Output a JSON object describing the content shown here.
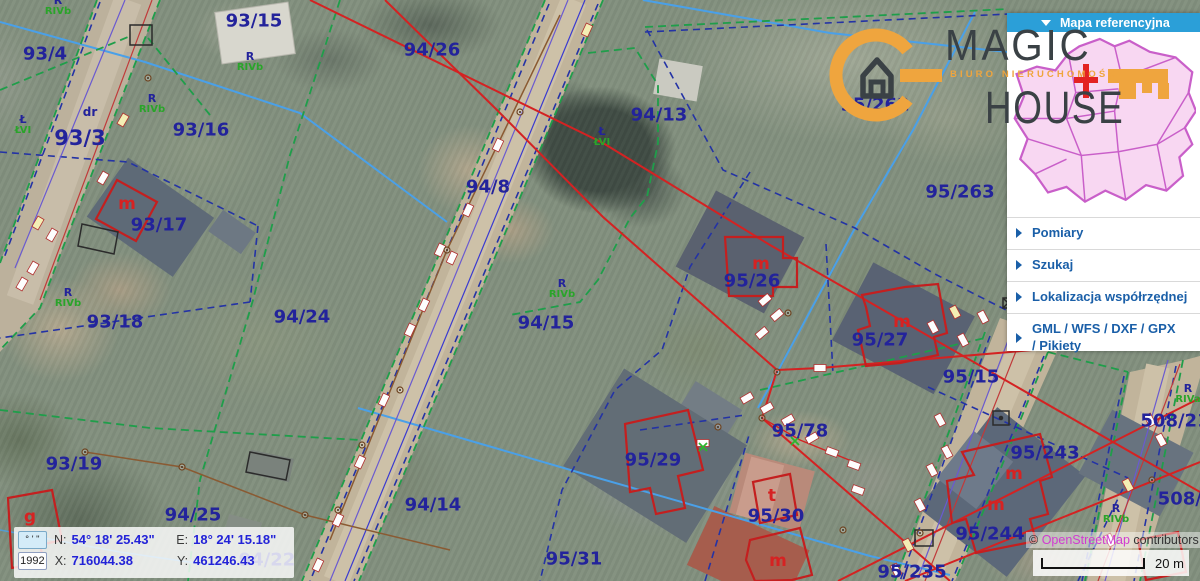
{
  "colors": {
    "header_blue": "#2b9fd8",
    "menu_blue": "#1a5fa8",
    "parcel_navy": "#23239b",
    "soil_green": "#2aa42a",
    "cadastral_red": "#d42222",
    "logo_orange": "#efa53e",
    "osm_link_pink": "#d13bd1"
  },
  "sidebar": {
    "header": "Mapa referencyjna",
    "items": [
      {
        "label": "Pomiary"
      },
      {
        "label": "Szukaj"
      },
      {
        "label": "Lokalizacja współrzędnej"
      },
      {
        "label": "GML / WFS / DXF / GPX / Pikiety"
      }
    ]
  },
  "logo": {
    "line1": "MAGIC",
    "line2": "HOUSE",
    "tagline": "BIURO NIERUCHOMOŚCI"
  },
  "coords_panel": {
    "dms_button": "° ' \"",
    "year_button": "1992",
    "n_label": "N:",
    "n_value": "54° 18' 25.43\"",
    "e_label": "E:",
    "e_value": "18° 24' 15.18\"",
    "x_label": "X:",
    "x_value": "716044.38",
    "y_label": "Y:",
    "y_value": "461246.43"
  },
  "attribution": {
    "prefix": "© ",
    "link": "OpenStreetMap",
    "suffix": " contributors"
  },
  "scale": {
    "label": "20 m"
  },
  "map": {
    "parcel_labels": [
      {
        "t": "93/15",
        "x": 254,
        "y": 21
      },
      {
        "t": "93/4",
        "x": 45,
        "y": 54
      },
      {
        "t": "94/26",
        "x": 432,
        "y": 50
      },
      {
        "t": "94/13",
        "x": 659,
        "y": 115
      },
      {
        "t": "95/262",
        "x": 875,
        "y": 105
      },
      {
        "t": "93/16",
        "x": 201,
        "y": 130
      },
      {
        "t": "93/3",
        "x": 80,
        "y": 138,
        "fs": 21
      },
      {
        "t": "93/17",
        "x": 159,
        "y": 225
      },
      {
        "t": "94/8",
        "x": 488,
        "y": 187
      },
      {
        "t": "95/263",
        "x": 960,
        "y": 192
      },
      {
        "t": "93/18",
        "x": 115,
        "y": 322
      },
      {
        "t": "94/24",
        "x": 302,
        "y": 317
      },
      {
        "t": "94/15",
        "x": 546,
        "y": 323
      },
      {
        "t": "95/26",
        "x": 752,
        "y": 281
      },
      {
        "t": "95/27",
        "x": 880,
        "y": 340
      },
      {
        "t": "95/15",
        "x": 971,
        "y": 377
      },
      {
        "t": "93/19",
        "x": 74,
        "y": 464
      },
      {
        "t": "94/25",
        "x": 193,
        "y": 515
      },
      {
        "t": "94/14",
        "x": 433,
        "y": 505
      },
      {
        "t": "95/29",
        "x": 653,
        "y": 460
      },
      {
        "t": "95/78",
        "x": 800,
        "y": 431
      },
      {
        "t": "95/30",
        "x": 776,
        "y": 516
      },
      {
        "t": "95/31",
        "x": 574,
        "y": 559
      },
      {
        "t": "94/22",
        "x": 267,
        "y": 560
      },
      {
        "t": "95/235",
        "x": 912,
        "y": 572
      },
      {
        "t": "95/243",
        "x": 1045,
        "y": 453
      },
      {
        "t": "95/244",
        "x": 990,
        "y": 534
      },
      {
        "t": "508/21",
        "x": 1175,
        "y": 421
      },
      {
        "t": "508/3",
        "x": 1186,
        "y": 499
      }
    ],
    "red_labels": [
      {
        "t": "m",
        "x": 127,
        "y": 204
      },
      {
        "t": "m",
        "x": 761,
        "y": 264
      },
      {
        "t": "m",
        "x": 902,
        "y": 322
      },
      {
        "t": "m",
        "x": 1014,
        "y": 474
      },
      {
        "t": "m",
        "x": 996,
        "y": 505
      },
      {
        "t": "m",
        "x": 778,
        "y": 561
      },
      {
        "t": "t",
        "x": 772,
        "y": 496
      },
      {
        "t": "g",
        "x": 30,
        "y": 517
      }
    ],
    "soil_labels": [
      {
        "a": "R",
        "b": "RIVb",
        "x": 58,
        "y": 6
      },
      {
        "a": "R",
        "b": "RIVb",
        "x": 250,
        "y": 62
      },
      {
        "a": "R",
        "b": "RIVb",
        "x": 152,
        "y": 104
      },
      {
        "a": "Ł",
        "b": "ŁVI",
        "x": 23,
        "y": 125
      },
      {
        "a": "R",
        "b": "RIVb",
        "x": 68,
        "y": 298
      },
      {
        "a": "R",
        "b": "RIVb",
        "x": 562,
        "y": 289
      },
      {
        "a": "Ł",
        "b": "ŁVI",
        "x": 602,
        "y": 137
      },
      {
        "a": "R",
        "b": "RIVa",
        "x": 1188,
        "y": 394
      },
      {
        "a": "R",
        "b": "RIVb",
        "x": 1116,
        "y": 514
      }
    ],
    "road_label": {
      "t": "dr",
      "x": 90,
      "y": 112
    },
    "utility_boxes": [
      {
        "x": 587,
        "y": 30,
        "r": -65,
        "c": "y"
      },
      {
        "x": 498,
        "y": 145,
        "r": -65,
        "c": "w"
      },
      {
        "x": 468,
        "y": 210,
        "r": -65,
        "c": "w"
      },
      {
        "x": 440,
        "y": 250,
        "r": -65,
        "c": "w"
      },
      {
        "x": 452,
        "y": 258,
        "r": -65,
        "c": "w"
      },
      {
        "x": 424,
        "y": 305,
        "r": -65,
        "c": "w"
      },
      {
        "x": 410,
        "y": 330,
        "r": -65,
        "c": "w"
      },
      {
        "x": 384,
        "y": 400,
        "r": -65,
        "c": "w"
      },
      {
        "x": 360,
        "y": 462,
        "r": -65,
        "c": "w"
      },
      {
        "x": 338,
        "y": 520,
        "r": -65,
        "c": "w"
      },
      {
        "x": 318,
        "y": 565,
        "r": -65,
        "c": "w"
      },
      {
        "x": 123,
        "y": 120,
        "r": -60,
        "c": "y"
      },
      {
        "x": 103,
        "y": 178,
        "r": -60,
        "c": "w"
      },
      {
        "x": 52,
        "y": 235,
        "r": -60,
        "c": "w"
      },
      {
        "x": 38,
        "y": 223,
        "r": -60,
        "c": "y"
      },
      {
        "x": 33,
        "y": 268,
        "r": -60,
        "c": "w"
      },
      {
        "x": 22,
        "y": 284,
        "r": -60,
        "c": "w"
      },
      {
        "x": 955,
        "y": 312,
        "r": 62,
        "c": "y"
      },
      {
        "x": 983,
        "y": 317,
        "r": 62,
        "c": "w"
      },
      {
        "x": 933,
        "y": 327,
        "r": 62,
        "c": "w"
      },
      {
        "x": 963,
        "y": 340,
        "r": 62,
        "c": "w"
      },
      {
        "x": 1063,
        "y": 342,
        "r": 62,
        "c": "y"
      },
      {
        "x": 940,
        "y": 420,
        "r": 62,
        "c": "w"
      },
      {
        "x": 947,
        "y": 452,
        "r": 62,
        "c": "w"
      },
      {
        "x": 932,
        "y": 470,
        "r": 62,
        "c": "w"
      },
      {
        "x": 920,
        "y": 505,
        "r": 62,
        "c": "w"
      },
      {
        "x": 908,
        "y": 545,
        "r": 62,
        "c": "y"
      },
      {
        "x": 896,
        "y": 570,
        "r": 62,
        "c": "w"
      },
      {
        "x": 747,
        "y": 398,
        "r": -30,
        "c": "w"
      },
      {
        "x": 767,
        "y": 408,
        "r": -30,
        "c": "w"
      },
      {
        "x": 788,
        "y": 420,
        "r": -30,
        "c": "w"
      },
      {
        "x": 812,
        "y": 438,
        "r": -30,
        "c": "w"
      },
      {
        "x": 832,
        "y": 452,
        "r": 20,
        "c": "w"
      },
      {
        "x": 854,
        "y": 465,
        "r": 20,
        "c": "w"
      },
      {
        "x": 703,
        "y": 443,
        "r": 0,
        "c": "w"
      },
      {
        "x": 765,
        "y": 300,
        "r": -40,
        "c": "w"
      },
      {
        "x": 777,
        "y": 315,
        "r": -40,
        "c": "w"
      },
      {
        "x": 762,
        "y": 333,
        "r": -40,
        "c": "w"
      },
      {
        "x": 820,
        "y": 368,
        "r": 0,
        "c": "w"
      },
      {
        "x": 858,
        "y": 490,
        "r": 20,
        "c": "w"
      },
      {
        "x": 1150,
        "y": 420,
        "r": 62,
        "c": "w"
      },
      {
        "x": 1128,
        "y": 485,
        "r": 62,
        "c": "y"
      },
      {
        "x": 1110,
        "y": 540,
        "r": 62,
        "c": "w"
      },
      {
        "x": 1161,
        "y": 440,
        "r": 62,
        "c": "w"
      }
    ],
    "poles": [
      [
        520,
        112
      ],
      [
        447,
        250
      ],
      [
        400,
        390
      ],
      [
        362,
        445
      ],
      [
        338,
        510
      ],
      [
        85,
        452
      ],
      [
        182,
        467
      ],
      [
        305,
        515
      ],
      [
        777,
        372
      ],
      [
        762,
        418
      ],
      [
        148,
        78
      ],
      [
        788,
        313
      ],
      [
        718,
        427
      ],
      [
        843,
        530
      ],
      [
        1152,
        480
      ],
      [
        920,
        533
      ]
    ],
    "green_marks": [
      [
        703,
        447
      ],
      [
        795,
        441
      ]
    ]
  }
}
